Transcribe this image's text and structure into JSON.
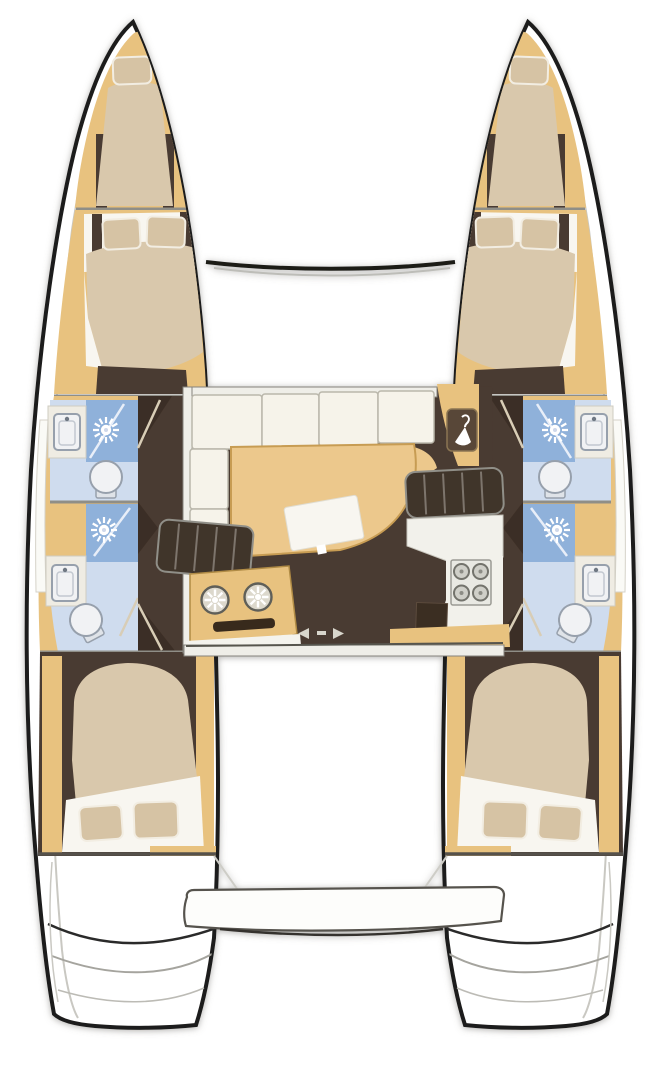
{
  "document": {
    "kind": "yacht deck floor plan",
    "vessel_type": "catamaran",
    "orientation": "bow at top, stern at bottom",
    "visible_text": ""
  },
  "palette": {
    "outline": "#1e1d1b",
    "deck": "#ffffff",
    "wood": "#e8c27f",
    "wood_dark": "#c99f55",
    "table": "#ecc88c",
    "floor": "#4a3a30",
    "floor_shadow": "#3b2e26",
    "mattress": "#d9c8ac",
    "sheet": "#f8f6f0",
    "pillow": "#d6c3a4",
    "bath": "#c3d3e8",
    "bath_light": "#cfdcee",
    "shower": "#8fb1da",
    "fixture": "#f1f2f4",
    "fixture_stroke": "#97a0ac",
    "wall": "#efeee8",
    "cushion": "#f6f3ea",
    "stairs": "#41342b",
    "stove": "#e9e9e3",
    "line_soft": "#c9c8c2"
  },
  "layout": {
    "hulls": {
      "count": 2,
      "mirrored": true,
      "rooms_bow_to_stern": [
        "forepeak-berth",
        "forward-double-cabin",
        "forward-bathroom (shower, toilet, sink)",
        "aft-bathroom (shower, sink, toilet)",
        "aft-double-cabin",
        "transom-steps"
      ]
    },
    "bridgedeck": {
      "saloon": [
        "l-shaped-settee",
        "dining-table",
        "nav-locker-with-hanger",
        "port-companionway-stairs",
        "starboard-companionway-stairs",
        "galley-double-sink",
        "galley-stove-four-burners",
        "fridge-counter",
        "aft-sliding-door"
      ],
      "exterior": [
        "forward-crossbeam",
        "trampoline-area",
        "cockpit",
        "aft-platform"
      ]
    },
    "icons": {
      "shower": "sunburst-spray-icon",
      "wardrobe": "coat-hanger-icon",
      "stove": "four-burner-icon",
      "sliding_door": "left-right-arrow-icon"
    },
    "counts": {
      "double_cabins": 4,
      "forepeak_berths": 2,
      "bathrooms": 4,
      "showers": 4,
      "toilets": 4,
      "bathroom_sinks": 4,
      "galley_sinks": 2,
      "stove_burners": 4
    }
  }
}
